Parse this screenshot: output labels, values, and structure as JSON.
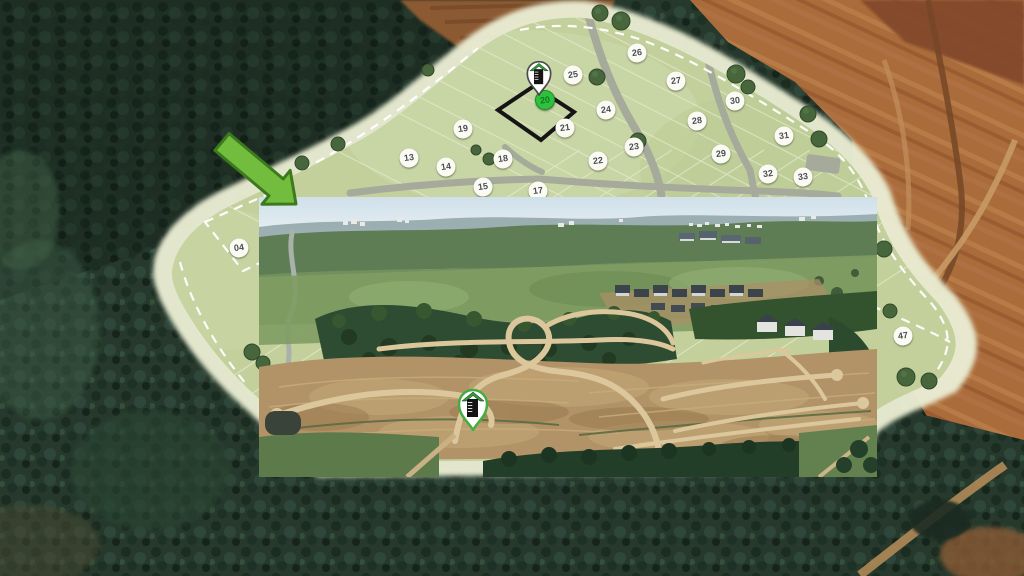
{
  "scene_title": "Land development masterplan over satellite photo with inset drone view",
  "plat": {
    "highlighted_lot": {
      "number": "20",
      "x": 545,
      "y": 100
    },
    "lots": [
      {
        "number": "04",
        "x": 239,
        "y": 248
      },
      {
        "number": "13",
        "x": 409,
        "y": 158
      },
      {
        "number": "14",
        "x": 446,
        "y": 167
      },
      {
        "number": "15",
        "x": 483,
        "y": 187
      },
      {
        "number": "17",
        "x": 538,
        "y": 191
      },
      {
        "number": "18",
        "x": 503,
        "y": 159
      },
      {
        "number": "19",
        "x": 463,
        "y": 129
      },
      {
        "number": "21",
        "x": 565,
        "y": 128
      },
      {
        "number": "22",
        "x": 598,
        "y": 161
      },
      {
        "number": "23",
        "x": 634,
        "y": 147
      },
      {
        "number": "24",
        "x": 606,
        "y": 110
      },
      {
        "number": "25",
        "x": 573,
        "y": 75
      },
      {
        "number": "26",
        "x": 637,
        "y": 53
      },
      {
        "number": "27",
        "x": 676,
        "y": 81
      },
      {
        "number": "28",
        "x": 697,
        "y": 121
      },
      {
        "number": "29",
        "x": 721,
        "y": 154
      },
      {
        "number": "30",
        "x": 735,
        "y": 101
      },
      {
        "number": "31",
        "x": 784,
        "y": 136
      },
      {
        "number": "32",
        "x": 768,
        "y": 174
      },
      {
        "number": "33",
        "x": 803,
        "y": 177
      },
      {
        "number": "47",
        "x": 903,
        "y": 336
      }
    ]
  },
  "markers": {
    "plat_pin": {
      "icon": "building-logo-pin-icon",
      "tip_x": 539,
      "tip_y": 96
    },
    "photo_pin": {
      "icon": "building-logo-pin-icon",
      "tip_x": 473,
      "tip_y": 431
    }
  },
  "arrow": {
    "icon": "green-arrow-icon",
    "direction": "down-right"
  },
  "inset_photo": {
    "x": 259,
    "y": 197,
    "width": 618,
    "height": 280
  },
  "colors": {
    "arrow_fill": "#72bd3d",
    "arrow_border": "#3c7a1d",
    "highlight_badge": "#2fc13e",
    "highlight_badge_text": "#0f7c1f",
    "lot_badge_bg": "#fbfbf4",
    "lot_badge_text": "#4b5054",
    "plat_green": "#c3d09c",
    "plat_edge": "#e9ecd2",
    "road_gray": "#a6aa9b",
    "pin_roof_green": "#2e9e38",
    "pin_body_black": "#141414",
    "lot20_outline": "#151515"
  }
}
